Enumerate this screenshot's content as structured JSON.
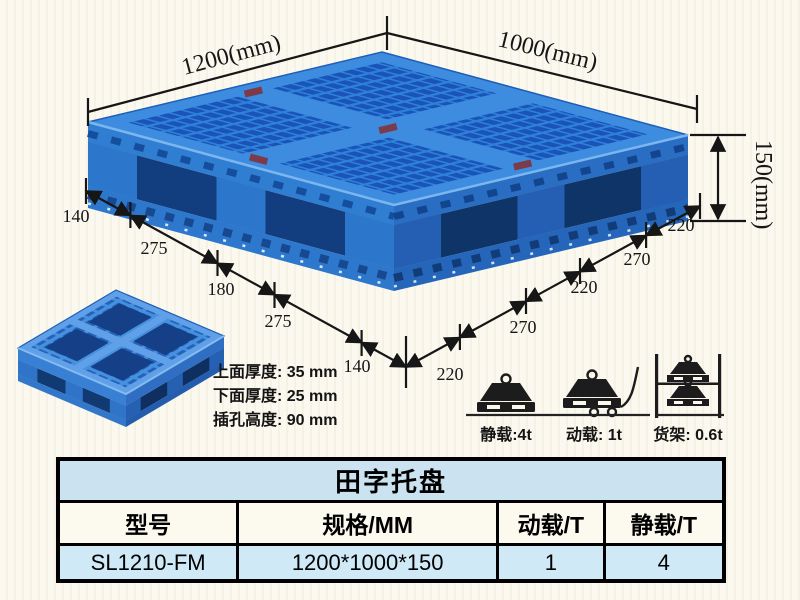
{
  "page": {
    "background": "#fbf9ef",
    "pallet_blue": "#2e80d8",
    "pallet_dark_blue": "#123d7e",
    "table_blue": "#cfe9f6"
  },
  "dimensions": {
    "length_label": "1200(mm)",
    "width_label": "1000(mm)",
    "height_label": "150(mm)",
    "left_chain": [
      "140",
      "275",
      "180",
      "275",
      "140"
    ],
    "right_chain": [
      "220",
      "270",
      "220",
      "270",
      "220"
    ]
  },
  "thickness_notes": {
    "line1": "上面厚度: 35 mm",
    "line2": "下面厚度: 25 mm",
    "line3": "插孔高度: 90 mm"
  },
  "load_ratings": [
    {
      "icon": "static-load-icon",
      "label": "静载:4t"
    },
    {
      "icon": "dynamic-load-icon",
      "label": "动载: 1t"
    },
    {
      "icon": "rack-load-icon",
      "label": "货架: 0.6t"
    }
  ],
  "spec_table": {
    "title": "田字托盘",
    "headers": [
      "型号",
      "规格/MM",
      "动载/T",
      "静载/T"
    ],
    "rows": [
      [
        "SL1210-FM",
        "1200*1000*150",
        "1",
        "4"
      ]
    ]
  }
}
